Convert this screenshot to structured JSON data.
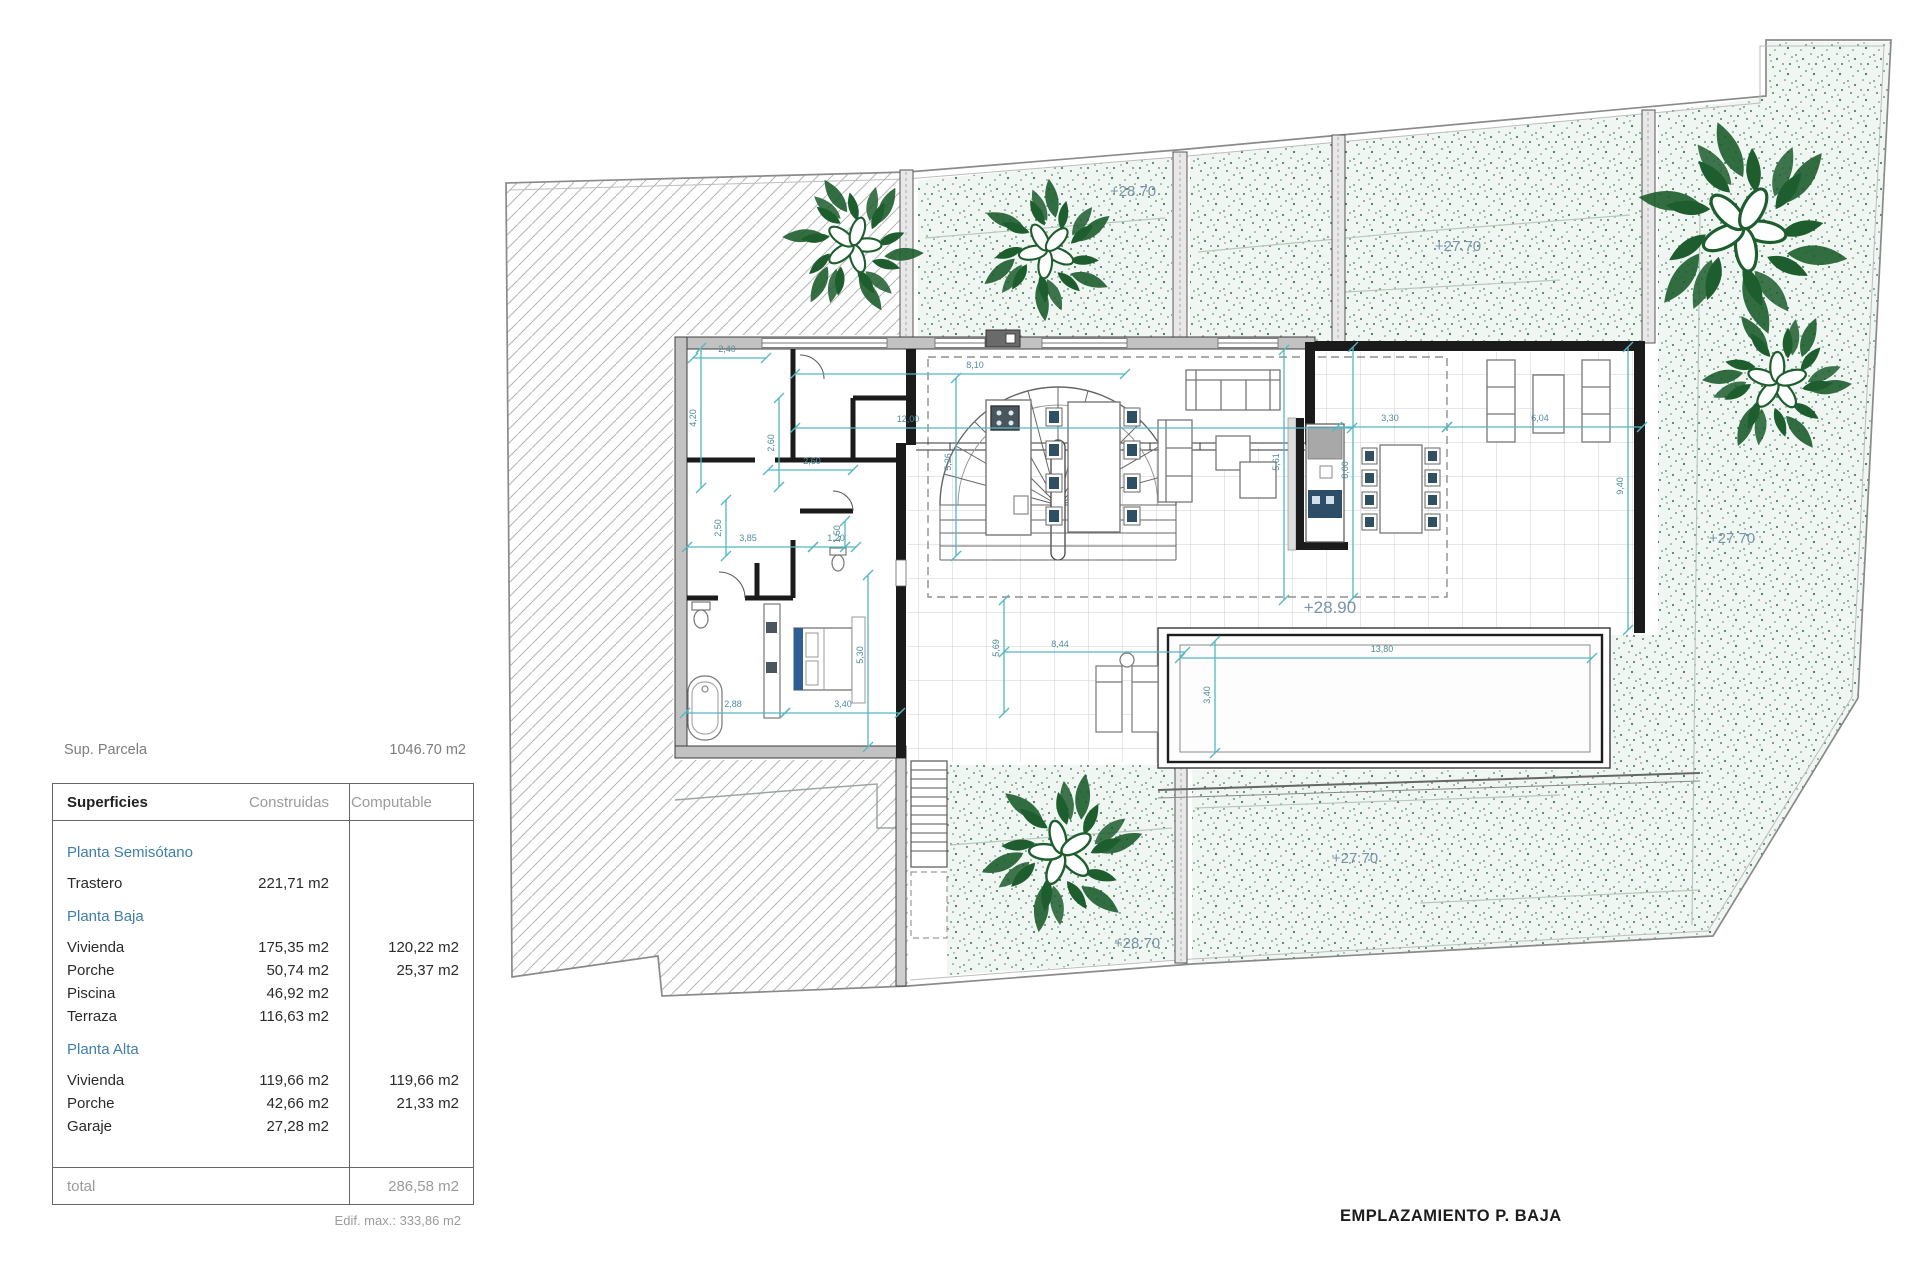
{
  "summary": {
    "parcel_label": "Sup. Parcela",
    "parcel_value": "1046.70 m2",
    "edif_max": "Edif. max.: 333,86 m2"
  },
  "table": {
    "headers": [
      "Superficies",
      "Construidas",
      "Computable"
    ],
    "sections": [
      {
        "title": "Planta Semisótano",
        "rows": [
          {
            "name": "Trastero",
            "construidas": "221,71 m2",
            "computable": ""
          }
        ]
      },
      {
        "title": "Planta Baja",
        "rows": [
          {
            "name": "Vivienda",
            "construidas": "175,35 m2",
            "computable": "120,22 m2"
          },
          {
            "name": "Porche",
            "construidas": "50,74 m2",
            "computable": "25,37 m2"
          },
          {
            "name": "Piscina",
            "construidas": "46,92 m2",
            "computable": ""
          },
          {
            "name": "Terraza",
            "construidas": "116,63 m2",
            "computable": ""
          }
        ]
      },
      {
        "title": "Planta Alta",
        "rows": [
          {
            "name": "Vivienda",
            "construidas": "119,66 m2",
            "computable": "119,66 m2"
          },
          {
            "name": "Porche",
            "construidas": "42,66 m2",
            "computable": "21,33 m2"
          },
          {
            "name": "Garaje",
            "construidas": "27,28 m2",
            "computable": ""
          }
        ]
      }
    ],
    "total_label": "total",
    "total_value": "286,58 m2"
  },
  "plan": {
    "title": {
      "text": "EMPLAZAMIENTO P. BAJA",
      "x": 1340,
      "y": 1221
    },
    "elevations": [
      {
        "t": "+28.70",
        "x": 1133,
        "y": 196,
        "s": 15
      },
      {
        "t": "+27.70",
        "x": 1458,
        "y": 251,
        "s": 15
      },
      {
        "t": "+27.70",
        "x": 1732,
        "y": 543,
        "s": 15
      },
      {
        "t": "+28.90",
        "x": 1330,
        "y": 613,
        "s": 17
      },
      {
        "t": "+27.70",
        "x": 1355,
        "y": 863,
        "s": 15
      },
      {
        "t": "+28.70",
        "x": 1137,
        "y": 948,
        "s": 15
      }
    ],
    "dimensions": [
      {
        "x1": 693,
        "y1": 358,
        "x2": 766,
        "y2": 358,
        "t": "2,40",
        "lx": 727,
        "ly": 352
      },
      {
        "x1": 701,
        "y1": 348,
        "x2": 701,
        "y2": 488,
        "t": "4,20",
        "lx": 696,
        "ly": 418,
        "rot": 1
      },
      {
        "x1": 779,
        "y1": 398,
        "x2": 779,
        "y2": 487,
        "t": "2,60",
        "lx": 774,
        "ly": 443,
        "rot": 1
      },
      {
        "x1": 768,
        "y1": 470,
        "x2": 853,
        "y2": 470,
        "t": "2,60",
        "lx": 812,
        "ly": 464
      },
      {
        "x1": 726,
        "y1": 500,
        "x2": 726,
        "y2": 556,
        "t": "2,50",
        "lx": 721,
        "ly": 528,
        "rot": 1
      },
      {
        "x1": 687,
        "y1": 547,
        "x2": 813,
        "y2": 547,
        "t": "3,85",
        "lx": 748,
        "ly": 541
      },
      {
        "x1": 813,
        "y1": 547,
        "x2": 856,
        "y2": 547,
        "t": "1,20",
        "lx": 836,
        "ly": 541
      },
      {
        "x1": 845,
        "y1": 521,
        "x2": 845,
        "y2": 547,
        "t": "1,50",
        "lx": 840,
        "ly": 534,
        "rot": 1
      },
      {
        "x1": 795,
        "y1": 374,
        "x2": 1125,
        "y2": 374,
        "t": "8,10",
        "lx": 975,
        "ly": 368
      },
      {
        "x1": 956,
        "y1": 378,
        "x2": 956,
        "y2": 556,
        "t": "5,26",
        "lx": 951,
        "ly": 462,
        "rot": 1
      },
      {
        "x1": 795,
        "y1": 428,
        "x2": 1352,
        "y2": 428,
        "t": "12,00",
        "lx": 908,
        "ly": 422
      },
      {
        "x1": 1284,
        "y1": 350,
        "x2": 1284,
        "y2": 600,
        "t": "5,61",
        "lx": 1279,
        "ly": 462,
        "rot": 1
      },
      {
        "x1": 1004,
        "y1": 600,
        "x2": 1004,
        "y2": 713,
        "t": "5,69",
        "lx": 999,
        "ly": 648,
        "rot": 1
      },
      {
        "x1": 1004,
        "y1": 652,
        "x2": 1185,
        "y2": 652,
        "t": "8,44",
        "lx": 1060,
        "ly": 647
      },
      {
        "x1": 685,
        "y1": 713,
        "x2": 785,
        "y2": 713,
        "t": "2,88",
        "lx": 733,
        "ly": 707
      },
      {
        "x1": 785,
        "y1": 713,
        "x2": 900,
        "y2": 713,
        "t": "3,40",
        "lx": 843,
        "ly": 707
      },
      {
        "x1": 868,
        "y1": 575,
        "x2": 868,
        "y2": 747,
        "t": "5,30",
        "lx": 863,
        "ly": 655,
        "rot": 1
      },
      {
        "x1": 1215,
        "y1": 641,
        "x2": 1215,
        "y2": 753,
        "t": "3,40",
        "lx": 1210,
        "ly": 695,
        "rot": 1
      },
      {
        "x1": 1180,
        "y1": 658,
        "x2": 1592,
        "y2": 658,
        "t": "13,80",
        "lx": 1382,
        "ly": 652
      },
      {
        "x1": 1337,
        "y1": 427,
        "x2": 1447,
        "y2": 427,
        "t": "3,30",
        "lx": 1390,
        "ly": 421
      },
      {
        "x1": 1447,
        "y1": 427,
        "x2": 1642,
        "y2": 427,
        "t": "6,04",
        "lx": 1540,
        "ly": 421
      },
      {
        "x1": 1353,
        "y1": 347,
        "x2": 1353,
        "y2": 598,
        "t": "8,00",
        "lx": 1348,
        "ly": 470,
        "rot": 1
      },
      {
        "x1": 1628,
        "y1": 347,
        "x2": 1628,
        "y2": 630,
        "t": "9,40",
        "lx": 1623,
        "ly": 486,
        "rot": 1
      }
    ]
  },
  "colors": {
    "dim_line": "#53b7c4",
    "dim_text": "#4f8d9d",
    "elevation_text": "#7a92a8",
    "section_accent": "#4080a8",
    "plant_green": "#1e5e2e",
    "title_text": "#1c1c1c"
  }
}
